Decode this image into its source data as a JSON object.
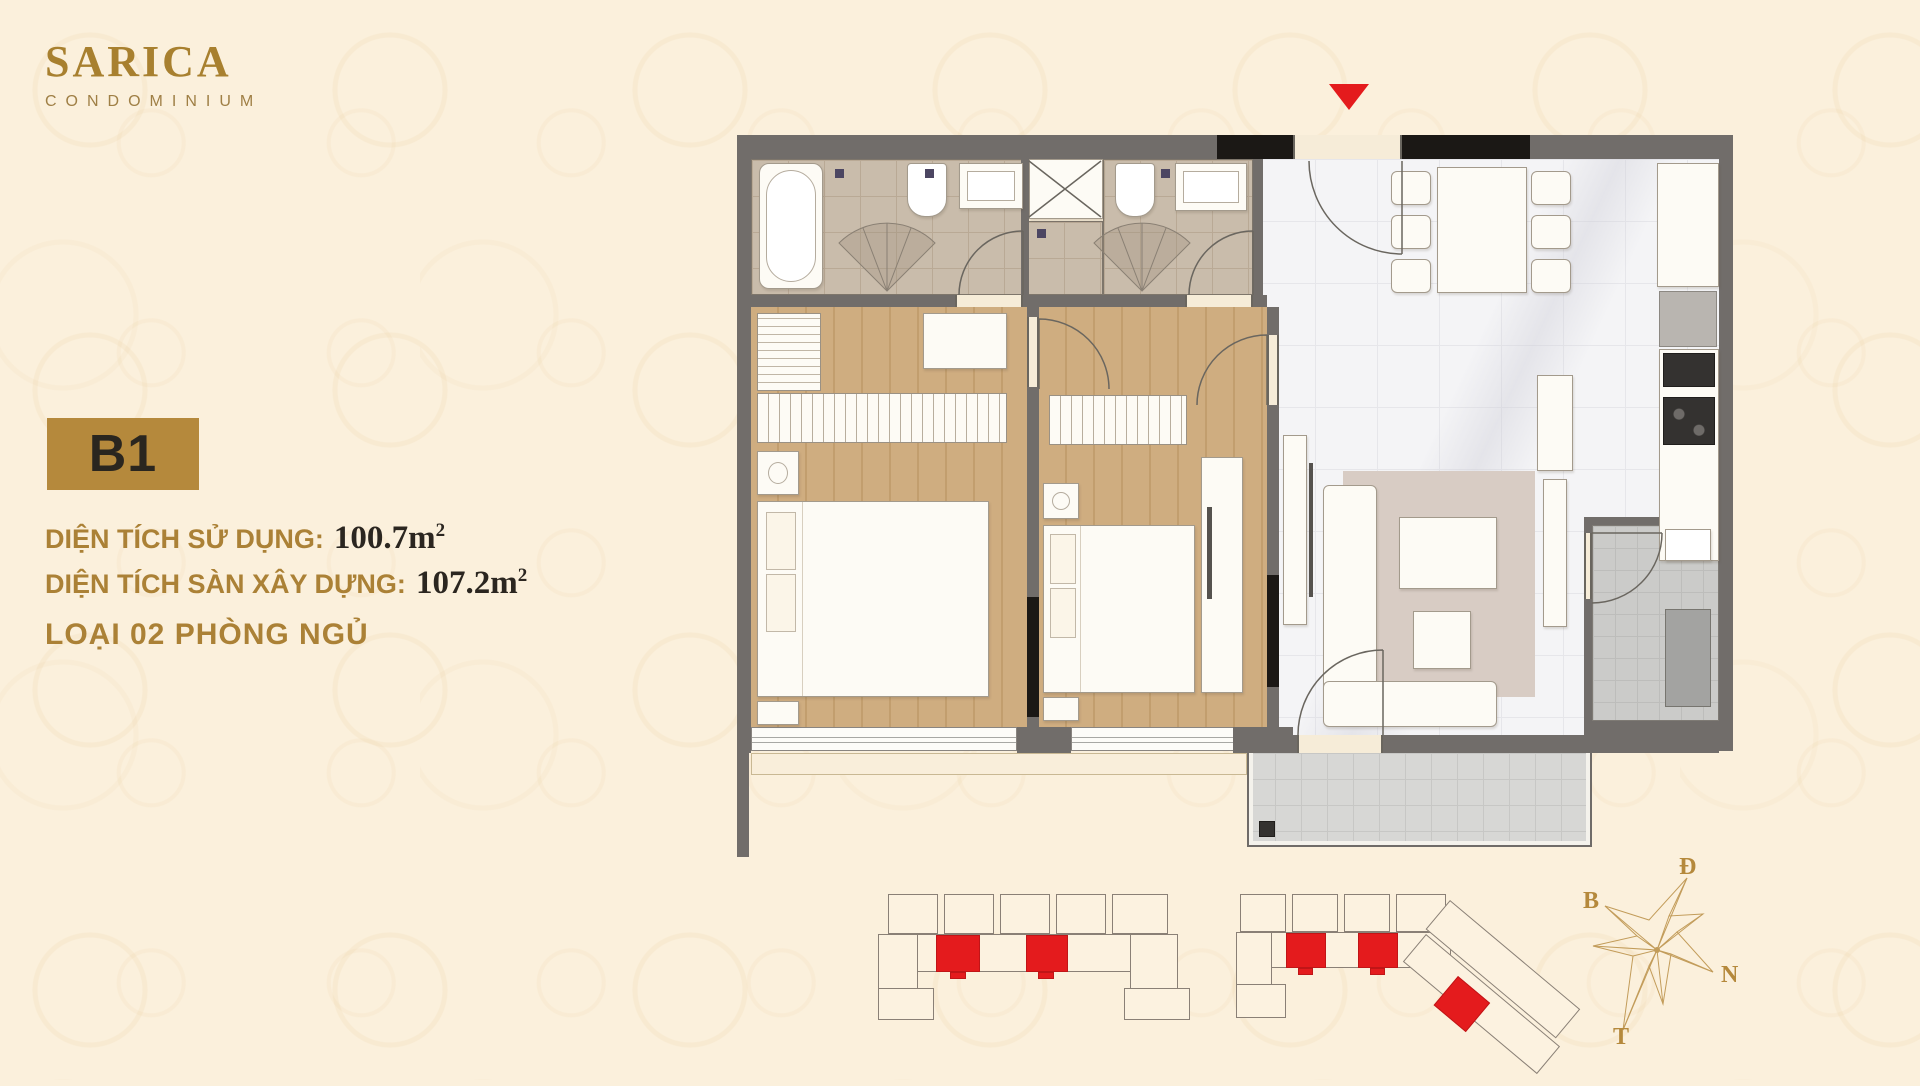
{
  "brand": {
    "name": "SARICA",
    "subtitle": "CONDOMINIUM"
  },
  "unit": {
    "code": "B1",
    "lines": [
      {
        "label": "DIỆN TÍCH SỬ DỤNG:",
        "value": "100.7",
        "unit": "m",
        "sup": "2"
      },
      {
        "label": "DIỆN TÍCH SÀN XÂY DỰNG:",
        "value": "107.2",
        "unit": "m",
        "sup": "2"
      }
    ],
    "type": "LOẠI 02 PHÒNG NGỦ"
  },
  "compass": {
    "east": "Đ",
    "north": "B",
    "south": "N",
    "west": "T"
  },
  "colors": {
    "background": "#fbf0dc",
    "brand_gold": "#a8802f",
    "badge_gold": "#b5893c",
    "text_dark": "#2b2620",
    "highlight_red": "#e41b1d"
  }
}
